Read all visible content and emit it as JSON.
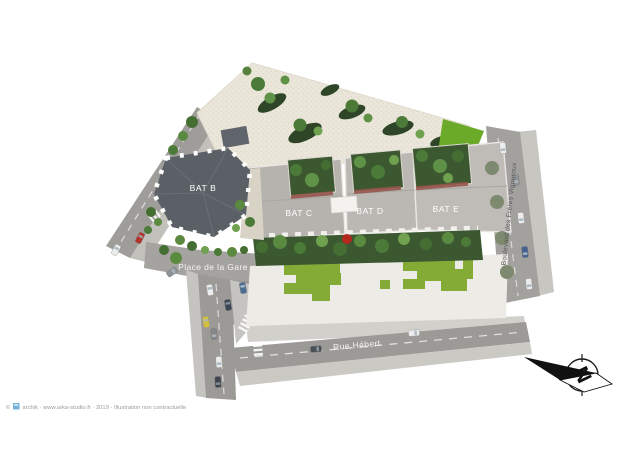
{
  "labels": {
    "bat_b": "BAT B",
    "bat_c": "BAT C",
    "bat_d": "BAT D",
    "bat_e": "BAT E",
    "place_de_la_gare": "Place de la Gare",
    "rue_hebert": "Rue Hébert",
    "boulevard": "Boulevard des Frères Vigouroux",
    "compass_letter": "N"
  },
  "credit": {
    "copyright": "©",
    "text": "archik · www.arka-studio.fr · 2019 · Illustration non contractuelle"
  },
  "colors": {
    "plaza": "#ebe6da",
    "lawn": "#85ab37",
    "lawn_bright": "#6aaa28",
    "hedge": "#3c5831",
    "road": "#9c9a97",
    "sidewalk": "#cbc9c4",
    "roof_dark": "#5b6067",
    "roof_light": "#bbb8b4",
    "forecourt": "#edebe5",
    "accent_red": "#b5271c"
  }
}
